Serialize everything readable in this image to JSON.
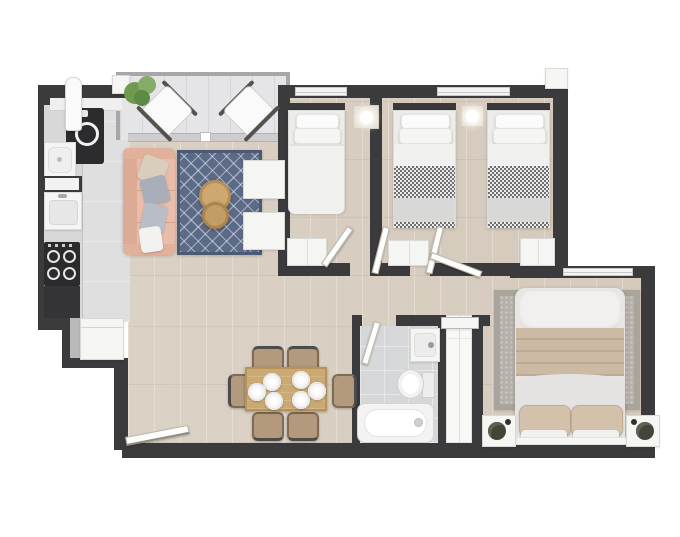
{
  "meta": {
    "title": "Apartment floor plan - top-down 3D render, no text labels",
    "type": "floor-plan"
  },
  "palette": {
    "wall": "#3b3b3d",
    "wood_floor": "#d9cfc2",
    "kitchen_floor": "#dfdfdf",
    "bathroom_floor": "#d6d7d9",
    "balcony_floor": "#e5e5e7",
    "rug_blue": "#5b6a86",
    "rug_gray": "#b5b1aa",
    "sofa_salmon": "#e9bda9",
    "table_wood": "#cba972",
    "appliance_dark": "#2c2c2e",
    "white_fixture": "#f5f5f4",
    "plant_green": "#6f9a50",
    "bedding_beige": "#ccbaa5",
    "background": "#ffffff"
  },
  "rooms": [
    {
      "id": "balcony",
      "label": "Balcony",
      "furniture": [
        "potted-plant",
        "lounge-chair",
        "lounge-chair",
        "sliding-glass-door"
      ]
    },
    {
      "id": "kitchen",
      "label": "Kitchen",
      "furniture": [
        "counter",
        "washing-machine",
        "laundry-sink",
        "kitchen-sink",
        "stove-4-burners",
        "refrigerator",
        "ironing-board"
      ]
    },
    {
      "id": "living-room",
      "label": "Living room",
      "furniture": [
        "sofa-3-seat",
        "cushions",
        "blue-pattern-rug",
        "round-coffee-tables",
        "armchair",
        "armchair"
      ]
    },
    {
      "id": "dining-area",
      "label": "Dining area",
      "furniture": [
        "dining-table",
        "plate",
        "plate",
        "plate",
        "plate",
        "plate",
        "plate",
        "chair",
        "chair",
        "chair",
        "chair",
        "chair",
        "chair"
      ]
    },
    {
      "id": "bedroom-1",
      "label": "Bedroom 1",
      "furniture": [
        "single-bed",
        "wall-light",
        "wardrobe",
        "window",
        "door"
      ]
    },
    {
      "id": "bedroom-2",
      "label": "Bedroom 2 (twin)",
      "furniture": [
        "single-bed-checkered",
        "single-bed-checkered",
        "wall-light",
        "wardrobe",
        "wardrobe",
        "window",
        "door"
      ]
    },
    {
      "id": "bathroom",
      "label": "Bathroom",
      "furniture": [
        "washbasin",
        "toilet",
        "bathtub",
        "door"
      ]
    },
    {
      "id": "closet",
      "label": "Closet",
      "furniture": [
        "sliding-wardrobe"
      ]
    },
    {
      "id": "master-bedroom",
      "label": "Master bedroom",
      "furniture": [
        "double-bed",
        "gray-rug",
        "nightstand-with-plant",
        "nightstand-with-plant",
        "window",
        "door"
      ]
    },
    {
      "id": "hallway",
      "label": "Hallway",
      "furniture": []
    },
    {
      "id": "entrance",
      "label": "Entrance",
      "furniture": [
        "entry-door"
      ]
    }
  ],
  "counts": {
    "bedrooms": 3,
    "beds": 4,
    "bathrooms": 1,
    "balconies": 1
  }
}
